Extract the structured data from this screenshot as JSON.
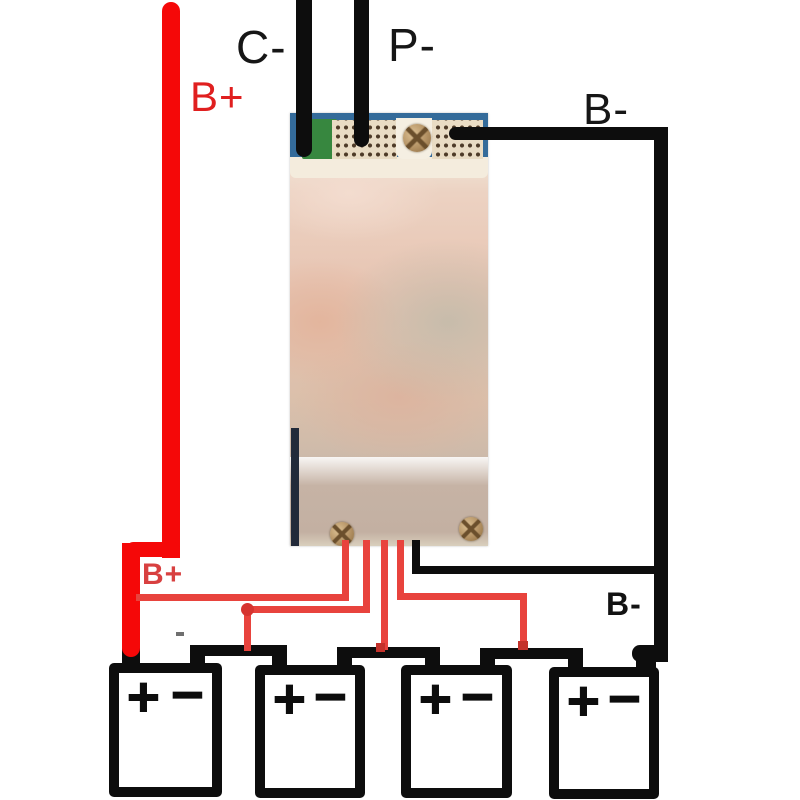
{
  "labels": {
    "b_plus_top": "B+",
    "c_minus": "C-",
    "p_minus": "P-",
    "b_minus_top": "B-",
    "b_plus_bottom": "B+",
    "b_minus_bottom": "B-"
  },
  "batteries": [
    {
      "plus": "+",
      "minus": "−"
    },
    {
      "plus": "+",
      "minus": "−"
    },
    {
      "plus": "+",
      "minus": "−"
    },
    {
      "plus": "+",
      "minus": "−"
    }
  ],
  "icons": {
    "top_screw": "screw-icon",
    "bottom_left_screw": "screw-icon",
    "bottom_right_screw": "screw-icon"
  },
  "colors": {
    "wire_red": "#f50808",
    "wire_red_thin": "#e8433d",
    "wire_black": "#0d0d0d",
    "label_red": "#e01f1f",
    "board_blue": "#346b9a",
    "board_green": "#37873f",
    "board_pink": "#e7c4b2",
    "pad_cream": "#e9dcc4",
    "screw_brass": "#b39163",
    "board_navy_edge": "#222a39"
  }
}
